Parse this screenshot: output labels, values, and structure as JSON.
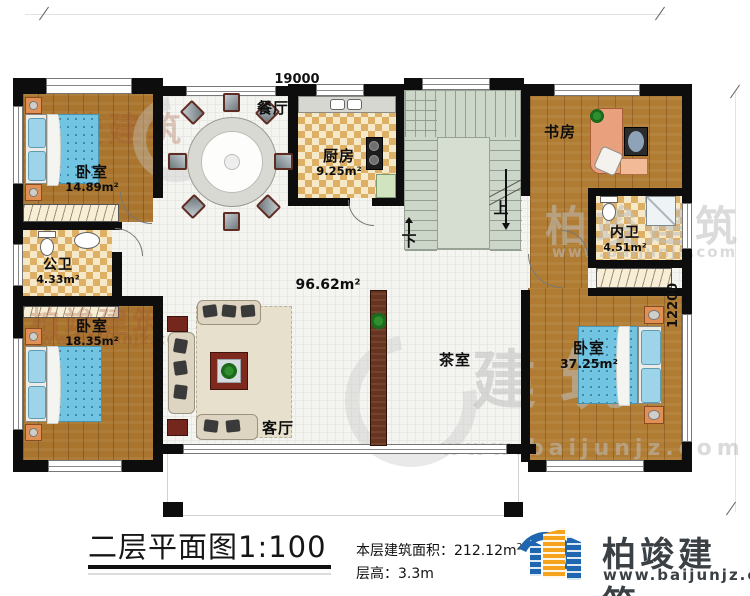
{
  "sheet": {
    "title": "二层平面图1:100",
    "stats": {
      "area_label": "本层建筑面积：",
      "area_value": "212.12m",
      "area_exponent": "2",
      "height_label": "层高：",
      "height_value": "3.3m"
    }
  },
  "branding": {
    "name": "柏竣建筑",
    "website": "www.baijunjz.com"
  },
  "dimensions": {
    "top": "19000",
    "right": "12200"
  },
  "plan": {
    "hall_area": "96.62m²",
    "stair_up": "上",
    "stair_down": "下",
    "rooms": {
      "bedroom_top_left": {
        "name": "卧室",
        "area": "14.89m²"
      },
      "public_bath": {
        "name": "公卫",
        "area": "4.33m²"
      },
      "bedroom_bottom_left": {
        "name": "卧室",
        "area": "18.35m²"
      },
      "dining": {
        "name": "餐厅"
      },
      "kitchen": {
        "name": "厨房",
        "area": "9.25m²"
      },
      "study": {
        "name": "书房"
      },
      "inner_bath": {
        "name": "内卫",
        "area": "4.51m²"
      },
      "bedroom_right": {
        "name": "卧室",
        "area": "37.25m²"
      },
      "tea_room": {
        "name": "茶室"
      },
      "living": {
        "name": "客厅"
      }
    }
  },
  "watermark": {
    "brand": "柏竣建筑",
    "site": "www.baijunjz.com",
    "chars": "建筑"
  },
  "colors": {
    "wall": "#0d0d0d",
    "wood": "#a9752e",
    "tile": "#f4f4f1",
    "stair": "#ccd6c9",
    "logo_blue": "#1f66b0",
    "logo_orange": "#f5a21c",
    "logo_text": "#3b4045"
  }
}
